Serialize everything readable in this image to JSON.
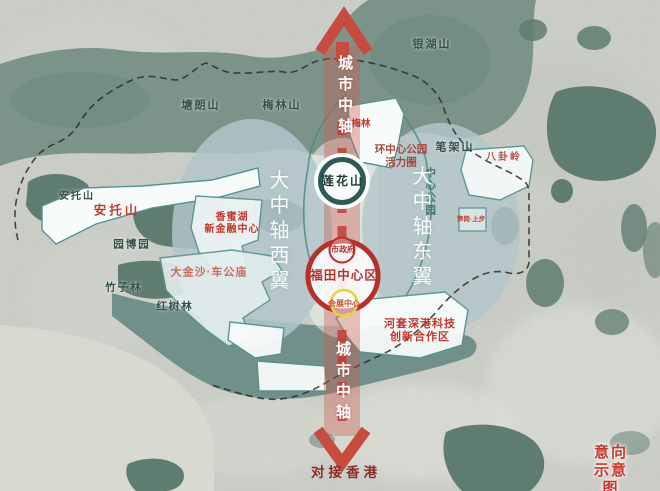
{
  "caption": {
    "text": "意向示意图"
  },
  "axis": {
    "top": "城市中轴",
    "bottom": "城市中轴",
    "south_link": "对接香港"
  },
  "wings": {
    "west": "大中轴西翼",
    "east": "大中轴东翼"
  },
  "rings": {
    "lotus_hill": "莲花山",
    "futian_center": "福田中心区",
    "city_hall": "市政府",
    "convention_center": "会展中心"
  },
  "parks": {
    "central_park_ring": "环中心公园\n活力圈",
    "central_park": "中心公园"
  },
  "mountains": {
    "yinhu": "银湖山",
    "tanglang": "塘朗山",
    "meilin_mtn": "梅林山",
    "bijia": "笔架山",
    "antuo_small": "安托山",
    "yuanbo": "园博园",
    "zhuzi": "竹子林",
    "hongshu": "红树林"
  },
  "districts": {
    "antuo": "安托山",
    "meilin": "梅林",
    "bagua": "八卦岭",
    "xiangmihu": "香蜜湖\n新金融中心",
    "dajinsha": "大金沙·车公庙",
    "sungang": "笋岗·上步",
    "hetao": "河套深港科技\n创新合作区"
  },
  "colors": {
    "axis_red": "#c84b40",
    "ring_red": "#b5322c",
    "ring_teal": "#2d5a54",
    "ring_yellow": "#e0d442",
    "wing_fill": "#b3c6cb",
    "band_green": "#7c938a",
    "patch_green": "#5f7c70",
    "label_dark": "#33504a",
    "label_red": "#c0392f"
  }
}
